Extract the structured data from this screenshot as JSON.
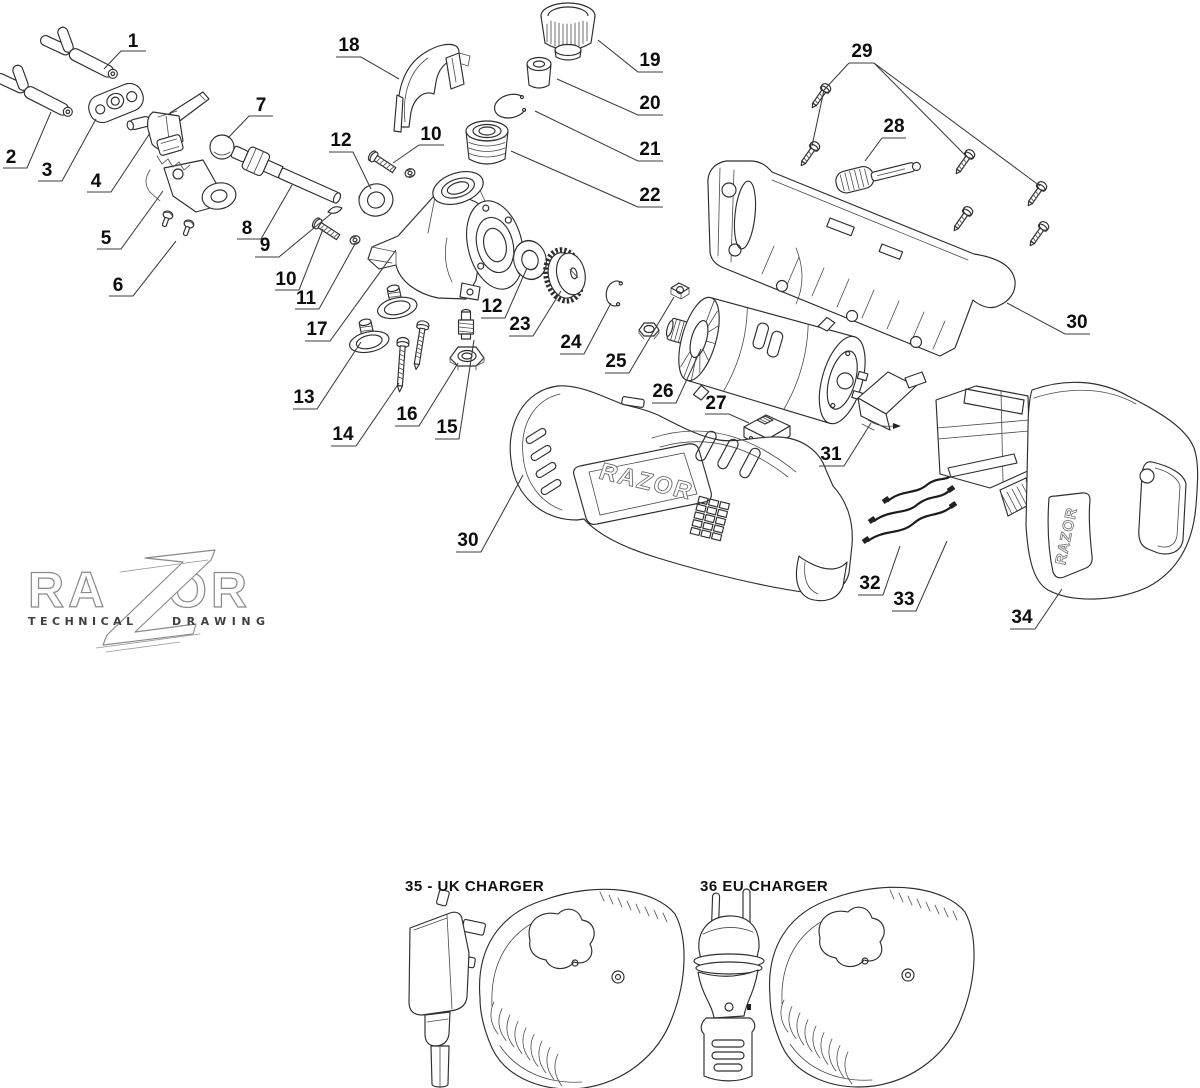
{
  "logo": {
    "brand_left": "RA",
    "brand_right": "OR",
    "word_left": "TECHNICAL",
    "word_right": "DRAWING"
  },
  "branding": {
    "body_logo": "RAZOR",
    "battery_logo": "RAZOR"
  },
  "captions": {
    "uk_charger": "35 - UK CHARGER",
    "eu_charger": "36 EU CHARGER"
  },
  "callouts": [
    {
      "num": "1",
      "x": 133,
      "y": 42,
      "leaders": [
        [
          [
            146,
            51
          ],
          [
            121,
            51
          ],
          [
            104,
            69
          ]
        ]
      ]
    },
    {
      "num": "2",
      "x": 11,
      "y": 158,
      "leaders": [
        [
          [
            3,
            168
          ],
          [
            27,
            168
          ],
          [
            51,
            112
          ]
        ]
      ]
    },
    {
      "num": "3",
      "x": 47,
      "y": 171,
      "leaders": [
        [
          [
            38,
            181
          ],
          [
            62,
            181
          ],
          [
            96,
            119
          ]
        ]
      ]
    },
    {
      "num": "4",
      "x": 96,
      "y": 182,
      "leaders": [
        [
          [
            87,
            192
          ],
          [
            111,
            192
          ],
          [
            150,
            133
          ]
        ]
      ]
    },
    {
      "num": "5",
      "x": 106,
      "y": 239,
      "leaders": [
        [
          [
            97,
            249
          ],
          [
            121,
            249
          ],
          [
            163,
            191
          ]
        ]
      ]
    },
    {
      "num": "6",
      "x": 118,
      "y": 286,
      "leaders": [
        [
          [
            109,
            296
          ],
          [
            133,
            296
          ],
          [
            176,
            241
          ]
        ]
      ]
    },
    {
      "num": "7",
      "x": 261,
      "y": 106,
      "leaders": [
        [
          [
            273,
            116
          ],
          [
            249,
            116
          ],
          [
            228,
            138
          ]
        ]
      ]
    },
    {
      "num": "8",
      "x": 247,
      "y": 229,
      "leaders": [
        [
          [
            237,
            239
          ],
          [
            261,
            239
          ],
          [
            292,
            185
          ]
        ]
      ]
    },
    {
      "num": "9",
      "x": 265,
      "y": 246,
      "leaders": [
        [
          [
            255,
            257
          ],
          [
            279,
            257
          ],
          [
            332,
            213
          ]
        ]
      ]
    },
    {
      "num": "10",
      "x": 431,
      "y": 135,
      "leaders": [
        [
          [
            444,
            145
          ],
          [
            419,
            145
          ],
          [
            393,
            163
          ]
        ]
      ]
    },
    {
      "num": "12",
      "x": 341,
      "y": 141,
      "leaders": [
        [
          [
            329,
            152
          ],
          [
            353,
            152
          ],
          [
            371,
            189
          ]
        ]
      ]
    },
    {
      "num": "10",
      "x": 286,
      "y": 280,
      "leaders": [
        [
          [
            275,
            290
          ],
          [
            299,
            290
          ],
          [
            323,
            229
          ]
        ]
      ]
    },
    {
      "num": "11",
      "x": 306,
      "y": 299,
      "leaders": [
        [
          [
            295,
            309
          ],
          [
            319,
            309
          ],
          [
            355,
            244
          ]
        ]
      ]
    },
    {
      "num": "17",
      "x": 317,
      "y": 330,
      "leaders": [
        [
          [
            305,
            341
          ],
          [
            330,
            341
          ],
          [
            396,
            250
          ]
        ]
      ]
    },
    {
      "num": "13",
      "x": 304,
      "y": 398,
      "leaders": [
        [
          [
            293,
            409
          ],
          [
            317,
            409
          ],
          [
            361,
            342
          ]
        ]
      ]
    },
    {
      "num": "14",
      "x": 343,
      "y": 435,
      "leaders": [
        [
          [
            331,
            446
          ],
          [
            356,
            446
          ],
          [
            399,
            383
          ]
        ]
      ]
    },
    {
      "num": "16",
      "x": 407,
      "y": 415,
      "leaders": [
        [
          [
            395,
            426
          ],
          [
            419,
            426
          ],
          [
            458,
            363
          ]
        ]
      ]
    },
    {
      "num": "15",
      "x": 447,
      "y": 428,
      "leaders": [
        [
          [
            435,
            439
          ],
          [
            459,
            439
          ],
          [
            474,
            340
          ]
        ]
      ]
    },
    {
      "num": "12",
      "x": 492,
      "y": 307,
      "leaders": [
        [
          [
            481,
            318
          ],
          [
            505,
            318
          ],
          [
            527,
            268
          ]
        ]
      ]
    },
    {
      "num": "23",
      "x": 520,
      "y": 325,
      "leaders": [
        [
          [
            509,
            336
          ],
          [
            533,
            336
          ],
          [
            561,
            291
          ]
        ]
      ]
    },
    {
      "num": "18",
      "x": 349,
      "y": 46,
      "leaders": [
        [
          [
            336,
            57
          ],
          [
            361,
            57
          ],
          [
            399,
            79
          ]
        ]
      ]
    },
    {
      "num": "19",
      "x": 650,
      "y": 61,
      "leaders": [
        [
          [
            663,
            72
          ],
          [
            638,
            72
          ],
          [
            598,
            40
          ]
        ]
      ]
    },
    {
      "num": "20",
      "x": 650,
      "y": 104,
      "leaders": [
        [
          [
            663,
            115
          ],
          [
            638,
            115
          ],
          [
            557,
            79
          ]
        ]
      ]
    },
    {
      "num": "21",
      "x": 650,
      "y": 150,
      "leaders": [
        [
          [
            663,
            161
          ],
          [
            638,
            161
          ],
          [
            535,
            111
          ]
        ]
      ]
    },
    {
      "num": "22",
      "x": 650,
      "y": 196,
      "leaders": [
        [
          [
            663,
            207
          ],
          [
            638,
            207
          ],
          [
            511,
            151
          ]
        ]
      ]
    },
    {
      "num": "24",
      "x": 571,
      "y": 343,
      "leaders": [
        [
          [
            560,
            354
          ],
          [
            584,
            354
          ],
          [
            611,
            303
          ]
        ]
      ]
    },
    {
      "num": "25",
      "x": 616,
      "y": 362,
      "leaders": [
        [
          [
            605,
            373
          ],
          [
            629,
            373
          ],
          [
            652,
            334
          ],
          [
            674,
            297
          ]
        ]
      ]
    },
    {
      "num": "26",
      "x": 663,
      "y": 392,
      "leaders": [
        [
          [
            652,
            403
          ],
          [
            676,
            403
          ],
          [
            701,
            349
          ]
        ]
      ]
    },
    {
      "num": "27",
      "x": 716,
      "y": 404,
      "leaders": [
        [
          [
            705,
            414
          ],
          [
            729,
            414
          ],
          [
            749,
            423
          ]
        ]
      ]
    },
    {
      "num": "28",
      "x": 894,
      "y": 127,
      "leaders": [
        [
          [
            906,
            138
          ],
          [
            882,
            138
          ],
          [
            865,
            161
          ]
        ]
      ]
    },
    {
      "num": "29",
      "x": 862,
      "y": 52,
      "leaders": [
        [
          [
            849,
            63
          ],
          [
            874,
            63
          ]
        ],
        [
          [
            849,
            63
          ],
          [
            824,
            90
          ],
          [
            812,
            146
          ]
        ],
        [
          [
            874,
            63
          ],
          [
            966,
            156
          ]
        ],
        [
          [
            874,
            63
          ],
          [
            1040,
            186
          ]
        ]
      ]
    },
    {
      "num": "30",
      "x": 1077,
      "y": 323,
      "leaders": [
        [
          [
            1090,
            334
          ],
          [
            1065,
            334
          ],
          [
            1007,
            303
          ]
        ]
      ]
    },
    {
      "num": "31",
      "x": 831,
      "y": 455,
      "leaders": [
        [
          [
            819,
            466
          ],
          [
            844,
            466
          ],
          [
            871,
            423
          ]
        ]
      ]
    },
    {
      "num": "30",
      "x": 468,
      "y": 541,
      "leaders": [
        [
          [
            456,
            552
          ],
          [
            481,
            552
          ],
          [
            523,
            475
          ]
        ]
      ]
    },
    {
      "num": "32",
      "x": 870,
      "y": 584,
      "leaders": [
        [
          [
            858,
            595
          ],
          [
            883,
            595
          ],
          [
            900,
            546
          ]
        ]
      ]
    },
    {
      "num": "33",
      "x": 904,
      "y": 600,
      "leaders": [
        [
          [
            892,
            611
          ],
          [
            916,
            611
          ],
          [
            947,
            541
          ]
        ]
      ]
    },
    {
      "num": "34",
      "x": 1022,
      "y": 618,
      "leaders": [
        [
          [
            1010,
            629
          ],
          [
            1035,
            629
          ],
          [
            1062,
            589
          ]
        ]
      ]
    }
  ]
}
